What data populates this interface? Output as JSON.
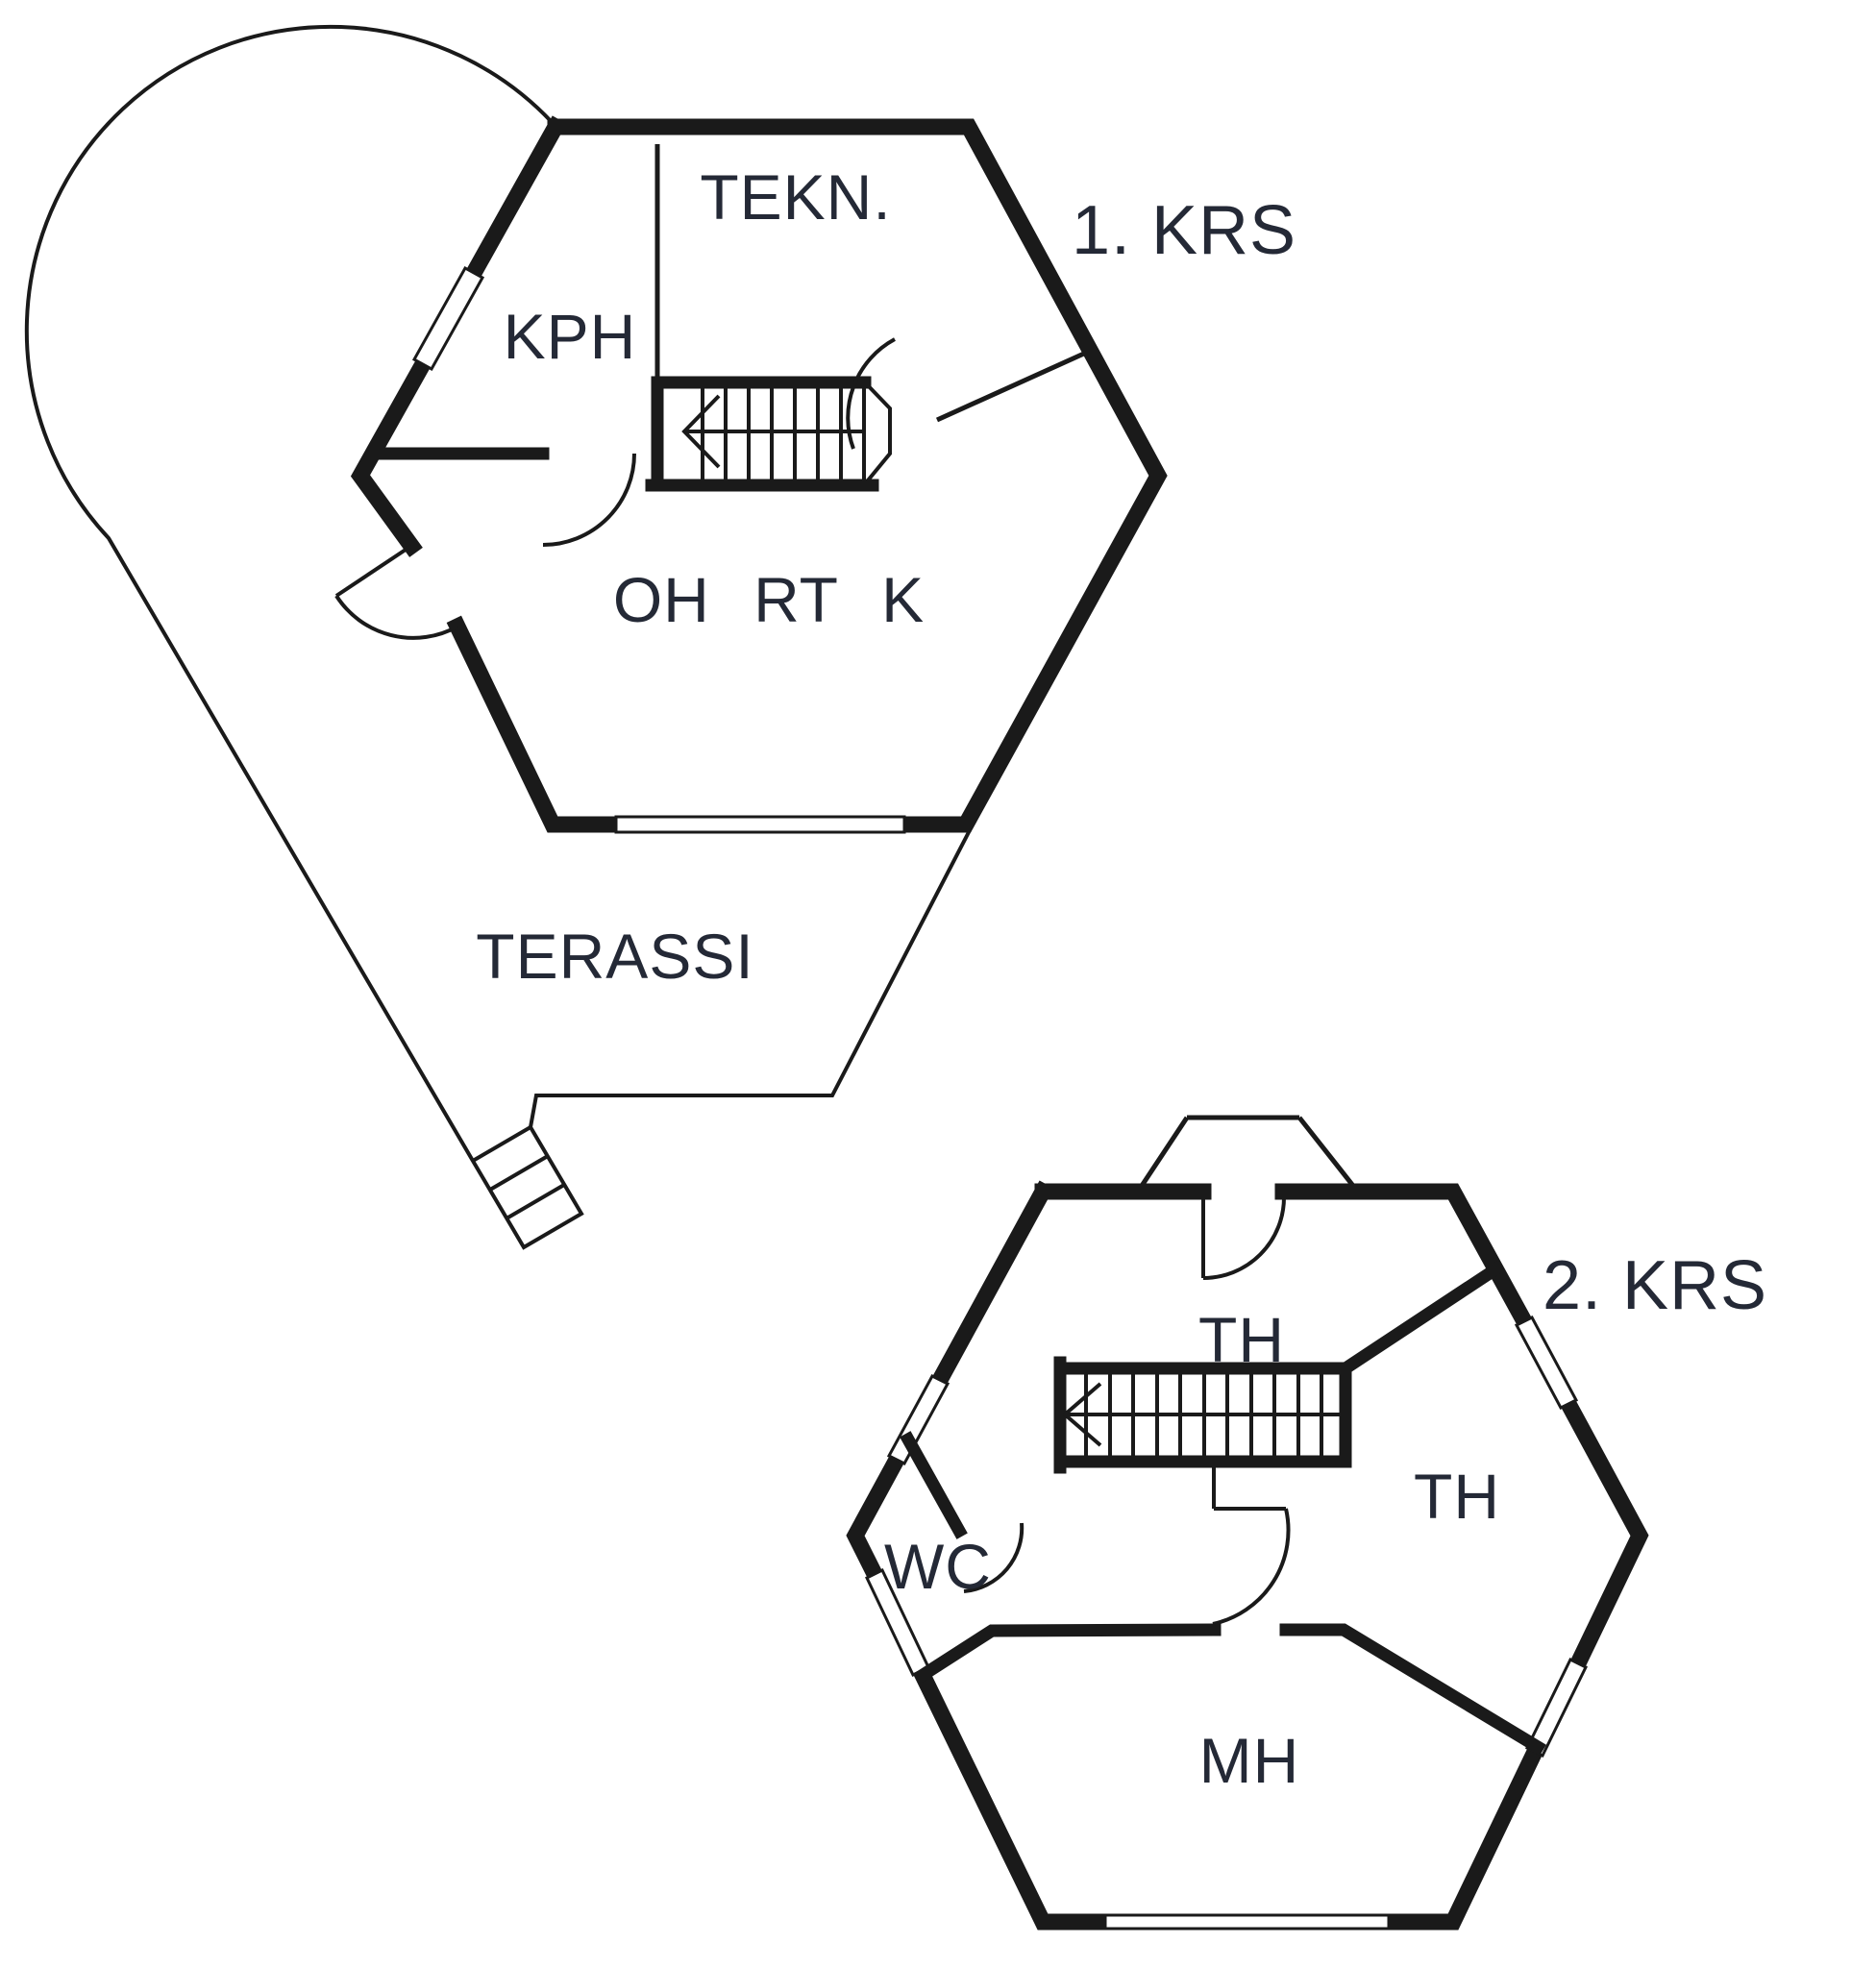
{
  "colors": {
    "wall": "#1a1a1a",
    "ink": "#242936",
    "background": "#ffffff"
  },
  "floor1": {
    "title": "1. KRS",
    "rooms": {
      "tekn": "TEKN.",
      "kph": "KPH",
      "living": "OH RT K"
    },
    "terrace": "TERASSI"
  },
  "floor2": {
    "title": "2. KRS",
    "rooms": {
      "th_upper": "TH",
      "th_right": "TH",
      "wc": "WC",
      "mh": "MH"
    }
  }
}
